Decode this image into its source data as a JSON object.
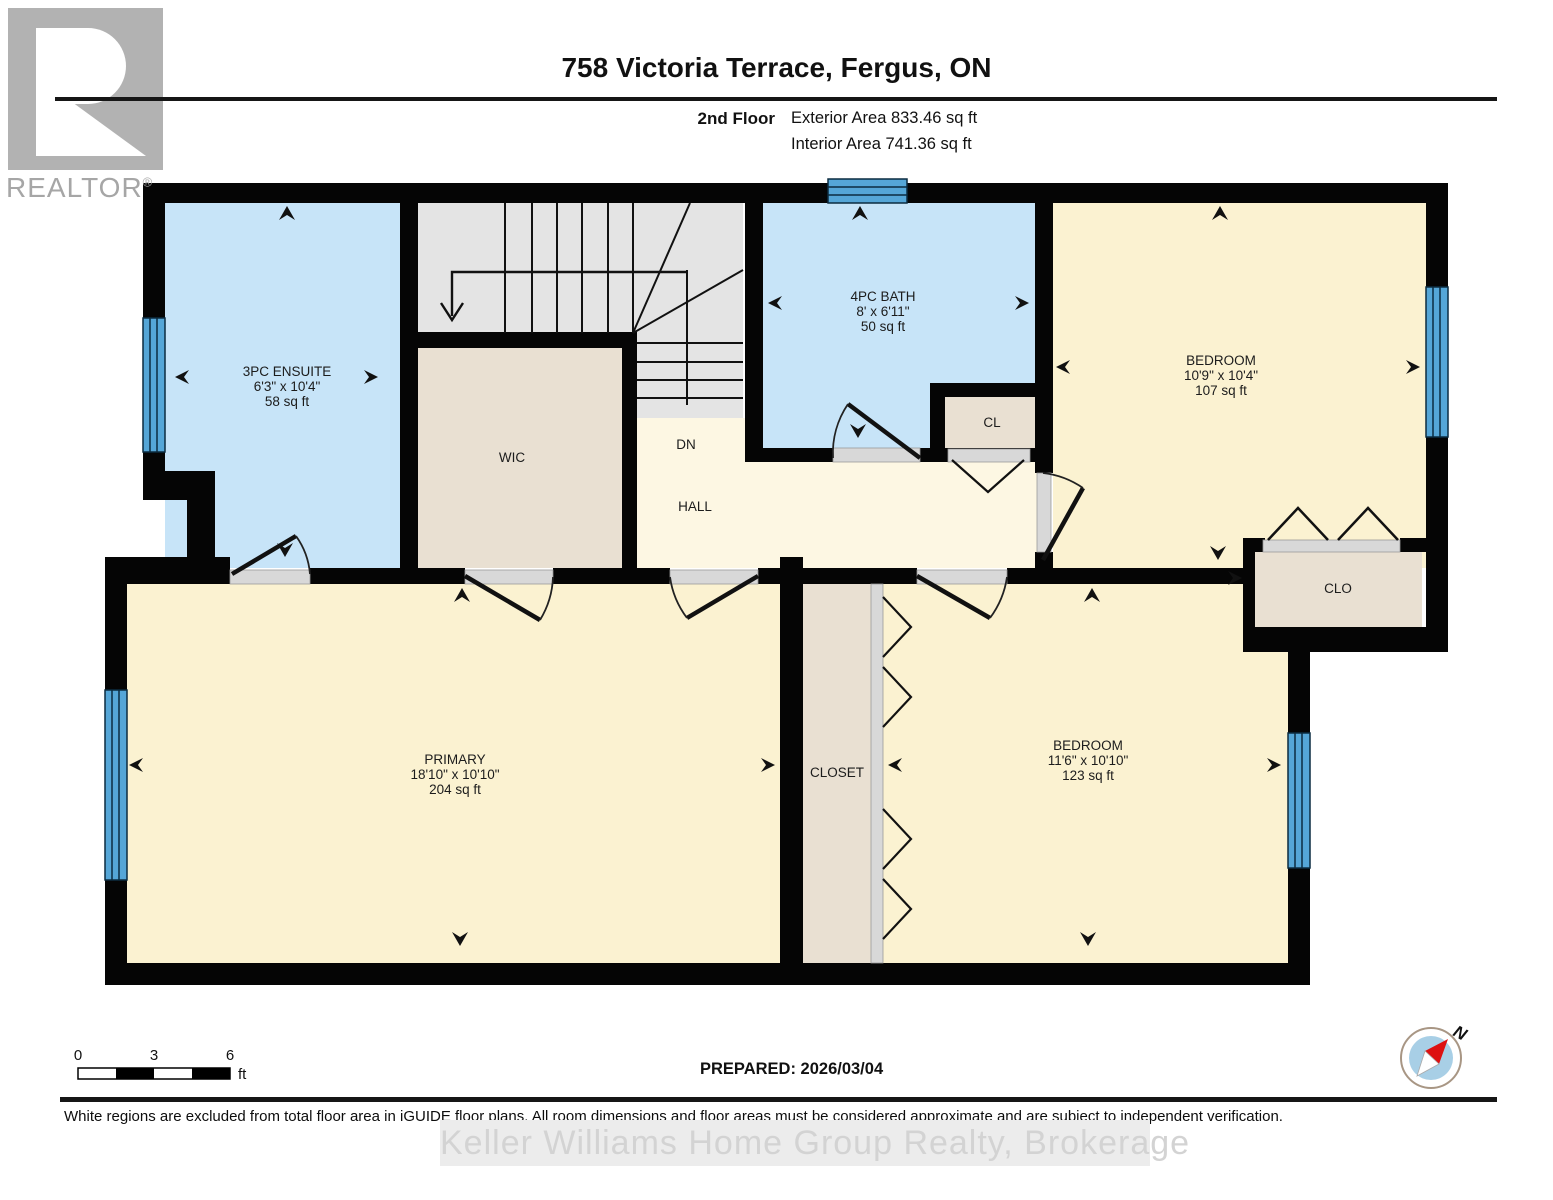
{
  "header": {
    "title": "758 Victoria Terrace, Fergus, ON",
    "floor_label": "2nd Floor",
    "exterior_area": "Exterior Area 833.46 sq ft",
    "interior_area": "Interior Area 741.36 sq ft"
  },
  "logo": {
    "brand": "REALTOR",
    "registered_mark": "®"
  },
  "rooms": {
    "ensuite": {
      "name": "3PC ENSUITE",
      "dims": "6'3\" x 10'4\"",
      "area": "58 sq ft"
    },
    "wic": {
      "name": "WIC"
    },
    "stairs": {
      "name": "DN"
    },
    "hall": {
      "name": "HALL"
    },
    "bath": {
      "name": "4PC BATH",
      "dims": "8' x 6'11\"",
      "area": "50 sq ft"
    },
    "cl": {
      "name": "CL"
    },
    "bedroom_upper": {
      "name": "BEDROOM",
      "dims": "10'9\" x 10'4\"",
      "area": "107 sq ft"
    },
    "clo": {
      "name": "CLO"
    },
    "primary": {
      "name": "PRIMARY",
      "dims": "18'10\" x 10'10\"",
      "area": "204 sq ft"
    },
    "closet": {
      "name": "CLOSET"
    },
    "bedroom_lower": {
      "name": "BEDROOM",
      "dims": "11'6\" x 10'10\"",
      "area": "123 sq ft"
    }
  },
  "scale_bar": {
    "tick0": "0",
    "tick1": "3",
    "tick2": "6",
    "unit": "ft"
  },
  "compass": {
    "north_label": "N"
  },
  "prepared": "PREPARED: 2026/03/04",
  "footer": {
    "disclaimer": "White regions are excluded from total floor area in iGUIDE floor plans. All room dimensions and floor areas must be considered approximate and are subject to independent verification.",
    "watermark": "Keller Williams Home Group Realty, Brokerage"
  },
  "colors": {
    "wall": "#050505",
    "room_yellow": "#fbf2d1",
    "hall_cream": "#fdf7e3",
    "room_blue": "#c7e4f8",
    "room_beige": "#e9e0d2",
    "stairs_gray": "#e4e4e4",
    "window_blue": "#55a6d7",
    "door_sill_gray": "#d8d8d8",
    "compass_blue": "#a8cfe6",
    "compass_needle_red": "#dd1111",
    "logo_gray": "#b2b2b2"
  }
}
